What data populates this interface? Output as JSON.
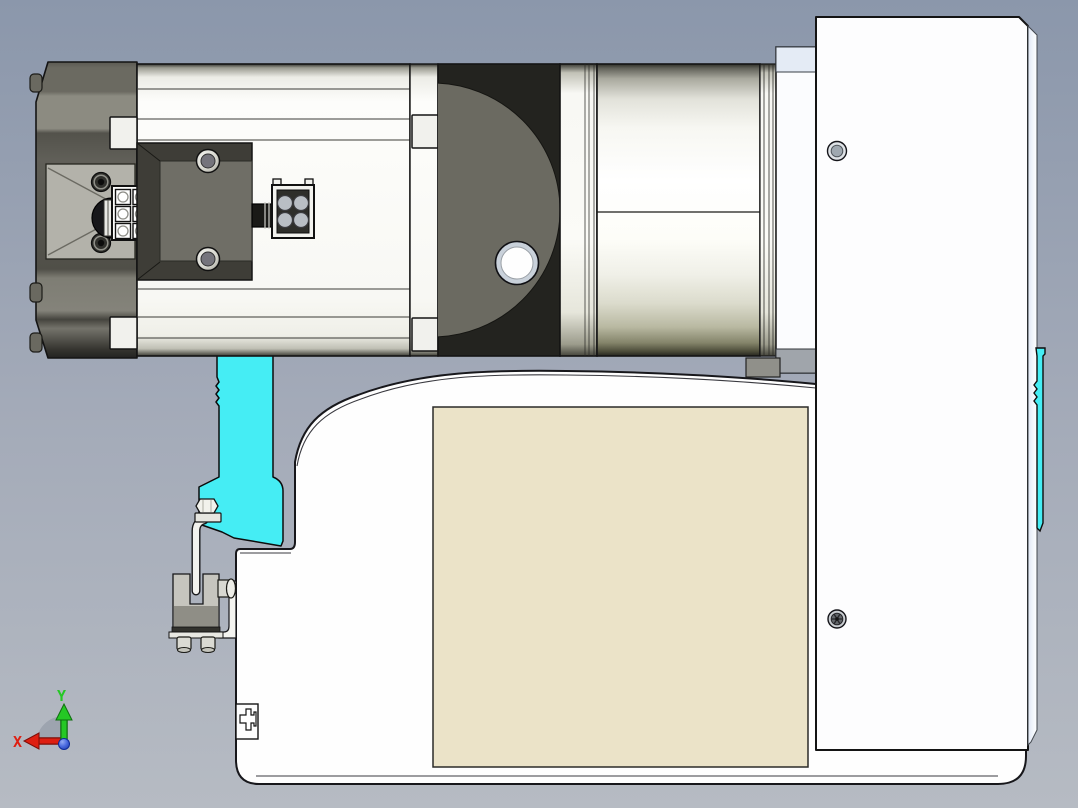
{
  "axis_triad": {
    "x_label": "X",
    "y_label": "Y"
  },
  "colors": {
    "background_top": "#8B97AB",
    "background_bottom": "#B6BBC3",
    "accent_cyan": "#45EDF4",
    "label_beige": "#EBE3C8",
    "housing_white": "#FEFEFE",
    "motor_dark_gray": "#53524B",
    "gearbox_face_gray": "#6B6A61",
    "axis_x_red": "#DE1F12",
    "axis_y_green": "#25C825",
    "origin_blue": "#2244CC"
  }
}
